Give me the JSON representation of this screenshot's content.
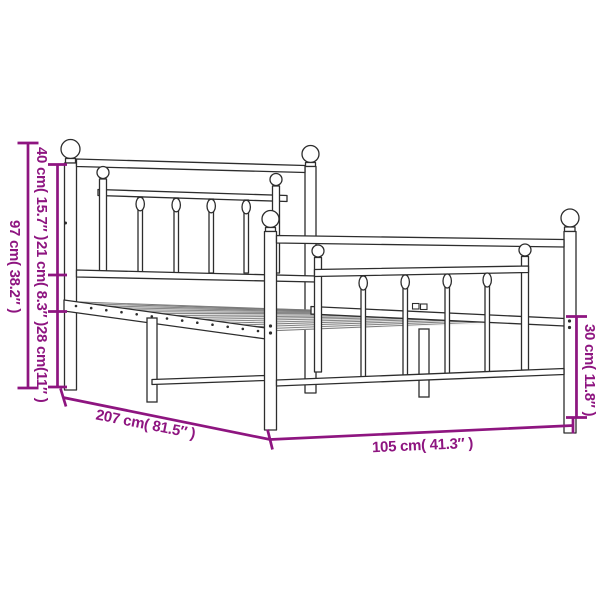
{
  "page": {
    "description": "Product dimension diagram of a metal bed frame with headboard and footboard",
    "background": "#ffffff"
  },
  "colors": {
    "annotation": "#8e1580",
    "outline": "#2d2d2d"
  },
  "dimensions": {
    "overall_height": {
      "cm": "97",
      "inches": "38.2",
      "label": "97 cm( 38.2″ )"
    },
    "headboard_upper_section": {
      "cm": "40",
      "inches": "15.7",
      "label": "40 cm( 15.7″ )"
    },
    "rail_to_base_section": {
      "cm": "21",
      "inches": "8.3",
      "label": "21 cm( 8.3″ )"
    },
    "base_to_floor_left": {
      "cm": "28",
      "inches": "11",
      "label": "28 cm(11″ )"
    },
    "frame_length": {
      "cm": "207",
      "inches": "81.5",
      "label": "207 cm( 81.5″ )"
    },
    "frame_width": {
      "cm": "105",
      "inches": "41.3",
      "label": "105 cm( 41.3″ )"
    },
    "base_to_floor_right": {
      "cm": "30",
      "inches": "11.8",
      "label": "30 cm( 11.8″ )"
    }
  }
}
